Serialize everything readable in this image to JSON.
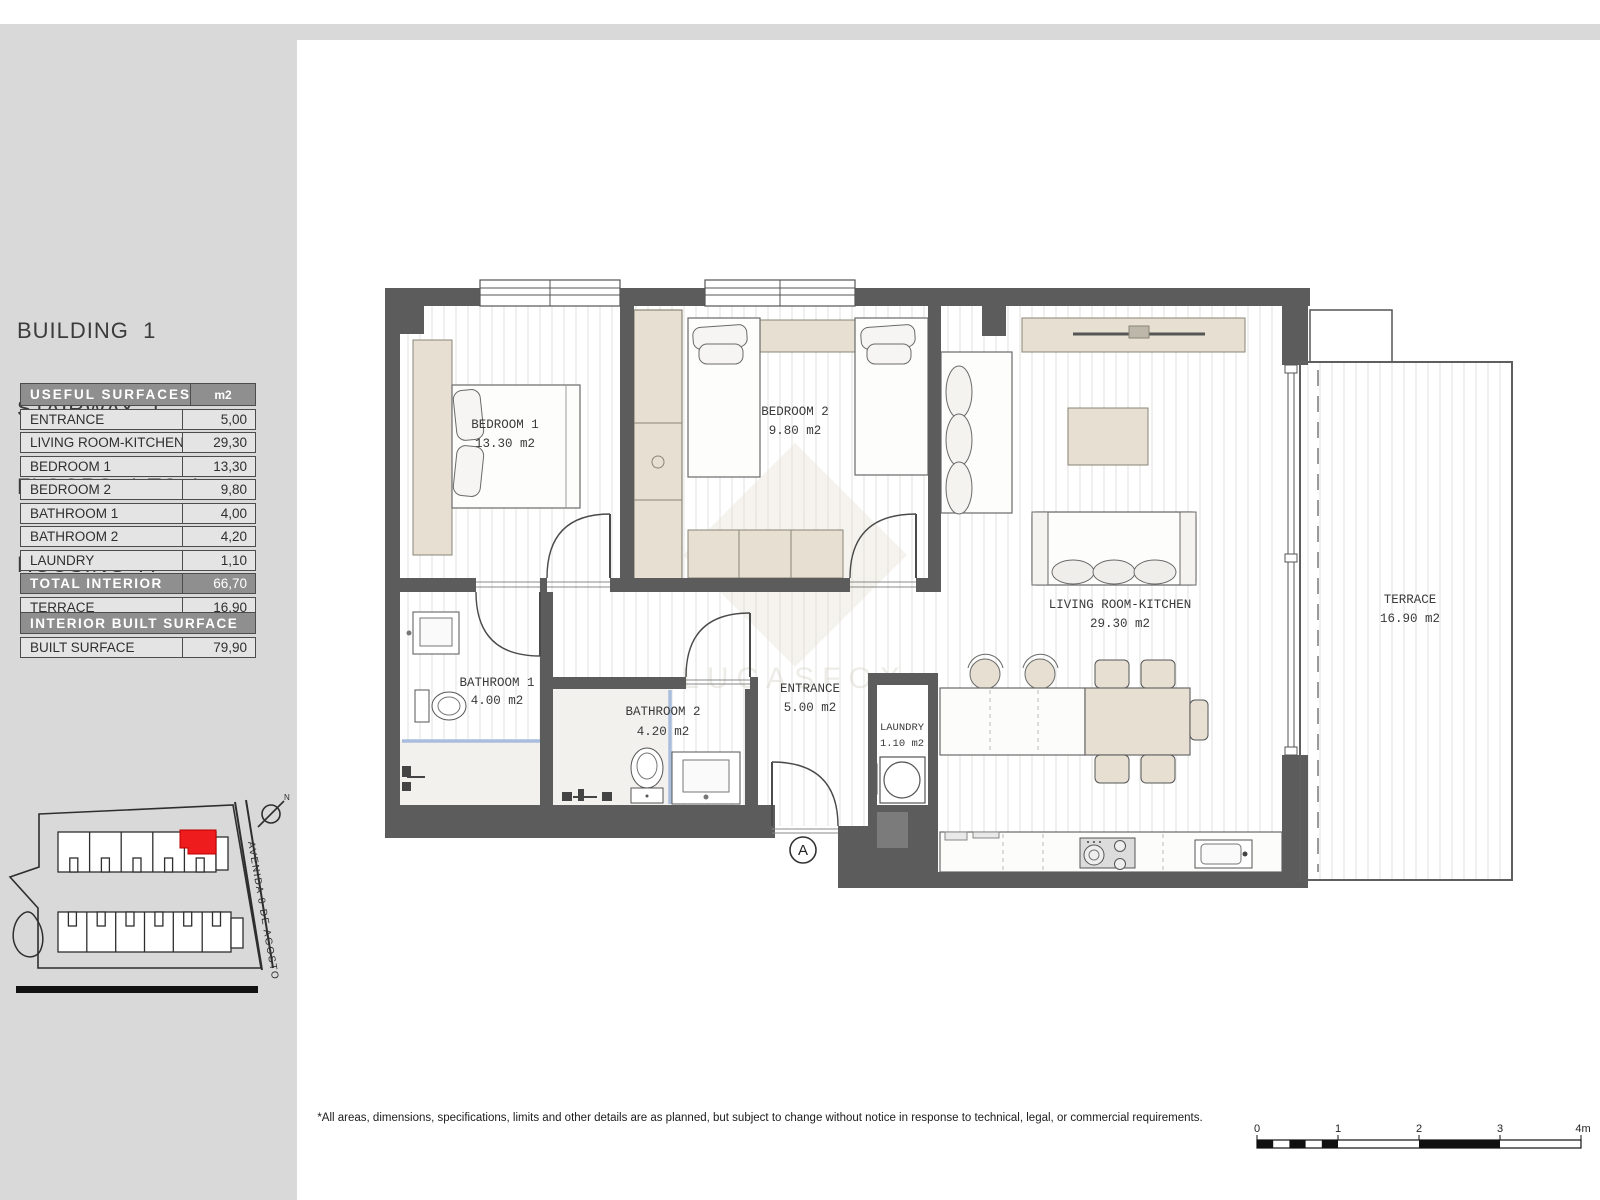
{
  "sidebar": {
    "title": [
      "BUILDING  1",
      "STAIRWAY  1",
      "FLOORS  1 TO 4",
      "HOUSING  A"
    ],
    "surfaces": {
      "header": "USEFUL SURFACES",
      "unit": "m2",
      "rows": [
        {
          "label": "ENTRANCE",
          "value": "5,00"
        },
        {
          "label": "LIVING ROOM-KITCHEN",
          "value": "29,30"
        },
        {
          "label": "BEDROOM 1",
          "value": "13,30"
        },
        {
          "label": "BEDROOM 2",
          "value": "9,80"
        },
        {
          "label": "BATHROOM 1",
          "value": "4,00"
        },
        {
          "label": "BATHROOM 2",
          "value": "4,20"
        },
        {
          "label": "LAUNDRY",
          "value": "1,10"
        },
        {
          "label": "TOTAL INTERIOR",
          "value": "66,70"
        },
        {
          "label": "TERRACE",
          "value": "16,90"
        }
      ]
    },
    "built": {
      "header": "INTERIOR BUILT SURFACE",
      "label": "BUILT SURFACE",
      "value": "79,90"
    },
    "siteplan": {
      "street": "AVENIDA 8 DE AGOSTO",
      "north": "N"
    }
  },
  "plan": {
    "rooms": {
      "bedroom1": {
        "name": "BEDROOM 1",
        "area": "13.30 m2"
      },
      "bedroom2": {
        "name": "BEDROOM 2",
        "area": "9.80 m2"
      },
      "living": {
        "name": "LIVING ROOM-KITCHEN",
        "area": "29.30 m2"
      },
      "terrace": {
        "name": "TERRACE",
        "area": "16.90 m2"
      },
      "entrance": {
        "name": "ENTRANCE",
        "area": "5.00 m2"
      },
      "laundry": {
        "name": "LAUNDRY",
        "area": "1.10 m2"
      },
      "bathroom1": {
        "name": "BATHROOM 1",
        "area": "4.00 m2"
      },
      "bathroom2": {
        "name": "BATHROOM 2",
        "area": "4.20 m2"
      }
    },
    "marker": "A",
    "watermark": {
      "monogram": "LF",
      "name": "LUCASFOX"
    }
  },
  "footer": {
    "disclaimer": "*All areas, dimensions, specifications, limits and other details are as planned, but subject to change without notice in response to technical, legal, or commercial requirements.",
    "scale": [
      "0",
      "1",
      "2",
      "3",
      "4m"
    ]
  },
  "colors": {
    "wall_gray": "#5c5c5c",
    "furniture_beige": "#e7dfd2",
    "highlight_red": "#ee1c1c",
    "band_gray": "#d9d9d9",
    "shower_glass_blue": "#a9bedd"
  }
}
